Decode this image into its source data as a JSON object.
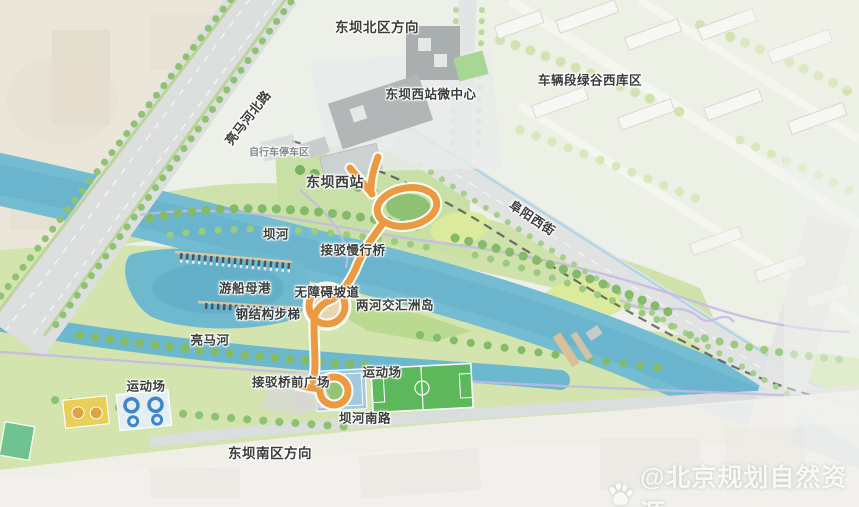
{
  "labels": {
    "north_direction": "东坝北区方向",
    "road_liangma_north": "亮马河北路",
    "micro_center": "东坝西站微中心",
    "depot_area": "车辆段绿谷西库区",
    "bike_parking": "自行车停车区",
    "station": "东坝西站",
    "road_fuyang_west": "阜阳西街",
    "river_bahe": "坝河",
    "footbridge": "接驳慢行桥",
    "marina": "游船母港",
    "barrier_free_ramp": "无障碍坡道",
    "confluence_island": "两河交汇洲岛",
    "steel_stairs": "钢结构步梯",
    "river_liangma": "亮马河",
    "sports_field_west": "运动场",
    "bridge_front_plaza": "接驳桥前广场",
    "sports_field_east": "运动场",
    "road_bahe_south": "坝河南路",
    "south_direction": "东坝南区方向"
  },
  "watermark": {
    "handle": "@北京规划自然资源",
    "icon": "baidu-paw"
  },
  "colors": {
    "bridge_orange": "#EC9A41",
    "water_teal": "#74BCD2",
    "park_green": "#CFE2AB",
    "road_gray": "#DFE2E1",
    "label_dark": "#3A3D3B"
  }
}
